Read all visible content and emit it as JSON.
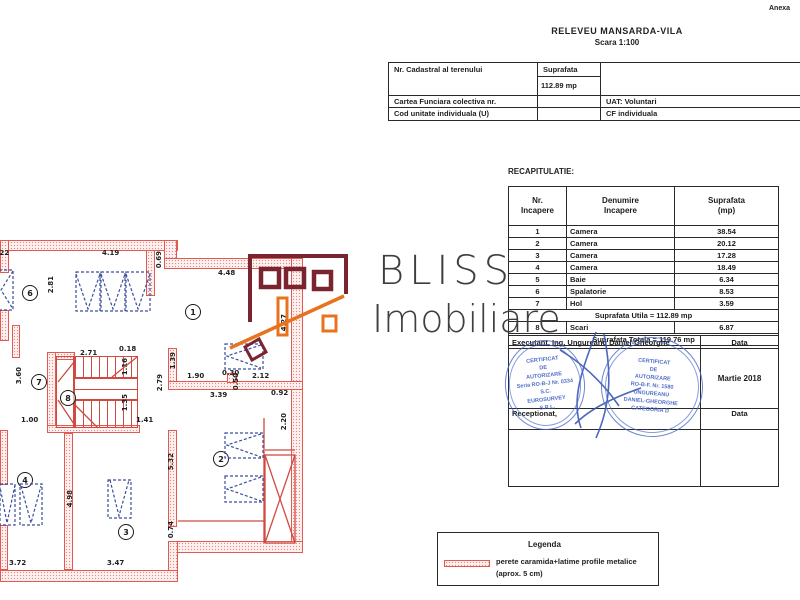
{
  "colors": {
    "wall_red": "#e05a52",
    "window_blue": "#3a4fa0",
    "stamp_blue": "#4868c4",
    "logo_maroon": "#7a2430",
    "logo_orange": "#e8731e"
  },
  "header": {
    "annex": "Anexa",
    "title": "RELEVEU MANSARDA-VILA",
    "scale": "Scara 1:100"
  },
  "cadastral": {
    "nr_label": "Nr. Cadastral al terenului",
    "area_label": "Suprafata",
    "area_value": "112.89 mp",
    "book_label": "Cartea Funciara colectiva nr.",
    "uat": "UAT: Voluntari",
    "code_label": "Cod unitate individuala (U)",
    "cf": "CF individuala"
  },
  "recap": {
    "title": "RECAPITULATIE:",
    "col_nr": "Nr.\nIncapere",
    "col_name": "Denumire\nIncapere",
    "col_area": "Suprafata\n(mp)",
    "rows": [
      [
        "1",
        "Camera",
        "38.54"
      ],
      [
        "2",
        "Camera",
        "20.12"
      ],
      [
        "3",
        "Camera",
        "17.28"
      ],
      [
        "4",
        "Camera",
        "18.49"
      ],
      [
        "5",
        "Baie",
        "6.34"
      ],
      [
        "6",
        "Spalatorie",
        "8.53"
      ],
      [
        "7",
        "Hol",
        "3.59"
      ]
    ],
    "utila": "Suprafata Utila = 112.89 mp",
    "row8": [
      "8",
      "Scari",
      "6.87"
    ],
    "totala": "Suprafata Totala = 119.76 mp",
    "executant": "Executant, Ing. Ungureanu Daniel-Gheorghe",
    "data_label": "Data",
    "date": "Martie 2018",
    "receptionat": "Receptionat,",
    "data_label2": "Data"
  },
  "stamps": {
    "left": [
      "CERTIFICAT",
      "DE",
      "AUTORIZARE",
      "Seria RO-B-J Nr. 0334",
      "S.C.",
      "EUROSURVEY",
      "S.R.L."
    ],
    "right": [
      "CERTIFICAT",
      "DE",
      "AUTORIZARE",
      "RO-B-F. Nr. 1580",
      "UNGUREANU",
      "DANIEL-GHEORGHE",
      "CATEGORIA D"
    ]
  },
  "logo": {
    "brand": "BLISS",
    "brand2": "Imobiliare"
  },
  "legend": {
    "title": "Legenda",
    "line1": "perete caramida+latime profile metalice",
    "line2": "(aprox. 5 cm)"
  },
  "plan": {
    "rooms": [
      {
        "n": "1",
        "x": 185,
        "y": 304
      },
      {
        "n": "2",
        "x": 213,
        "y": 451
      },
      {
        "n": "3",
        "x": 118,
        "y": 524
      },
      {
        "n": "4",
        "x": 17,
        "y": 472
      },
      {
        "n": "6",
        "x": 22,
        "y": 285
      },
      {
        "n": "7",
        "x": 31,
        "y": 374
      },
      {
        "n": "8",
        "x": 60,
        "y": 390
      },
      {
        "n": "5",
        "x": 205,
        "y": 360
      }
    ],
    "dims": [
      {
        "t": "1.22",
        "x": -8,
        "y": 249,
        "v": false
      },
      {
        "t": "4.19",
        "x": 102,
        "y": 249,
        "v": false
      },
      {
        "t": "4.48",
        "x": 218,
        "y": 269,
        "v": false
      },
      {
        "t": "2.71",
        "x": 80,
        "y": 349,
        "v": false
      },
      {
        "t": "0.18",
        "x": 119,
        "y": 345,
        "v": false
      },
      {
        "t": "1.90",
        "x": 187,
        "y": 372,
        "v": false
      },
      {
        "t": "0.30",
        "x": 222,
        "y": 369,
        "v": false
      },
      {
        "t": "2.12",
        "x": 252,
        "y": 372,
        "v": false
      },
      {
        "t": "3.39",
        "x": 210,
        "y": 391,
        "v": false
      },
      {
        "t": "0.92",
        "x": 271,
        "y": 389,
        "v": false
      },
      {
        "t": "1.00",
        "x": 21,
        "y": 416,
        "v": false
      },
      {
        "t": "1.41",
        "x": 136,
        "y": 416,
        "v": false
      },
      {
        "t": "3.72",
        "x": 9,
        "y": 559,
        "v": false
      },
      {
        "t": "3.47",
        "x": 107,
        "y": 559,
        "v": false
      },
      {
        "t": "0.69",
        "x": 155,
        "y": 251,
        "v": true
      },
      {
        "t": "2.81",
        "x": 47,
        "y": 276,
        "v": true
      },
      {
        "t": "4.27",
        "x": 280,
        "y": 314,
        "v": true
      },
      {
        "t": "3.60",
        "x": 15,
        "y": 367,
        "v": true
      },
      {
        "t": "1.39",
        "x": 169,
        "y": 352,
        "v": true
      },
      {
        "t": "2.79",
        "x": 156,
        "y": 374,
        "v": true
      },
      {
        "t": "1.16",
        "x": 121,
        "y": 358,
        "v": true
      },
      {
        "t": "1.35",
        "x": 121,
        "y": 394,
        "v": true
      },
      {
        "t": "0.50",
        "x": 232,
        "y": 373,
        "v": true
      },
      {
        "t": "2.20",
        "x": 280,
        "y": 413,
        "v": true
      },
      {
        "t": "5.32",
        "x": 167,
        "y": 453,
        "v": true
      },
      {
        "t": "4.98",
        "x": 66,
        "y": 490,
        "v": true
      },
      {
        "t": "0.74",
        "x": 167,
        "y": 521,
        "v": true
      }
    ]
  }
}
